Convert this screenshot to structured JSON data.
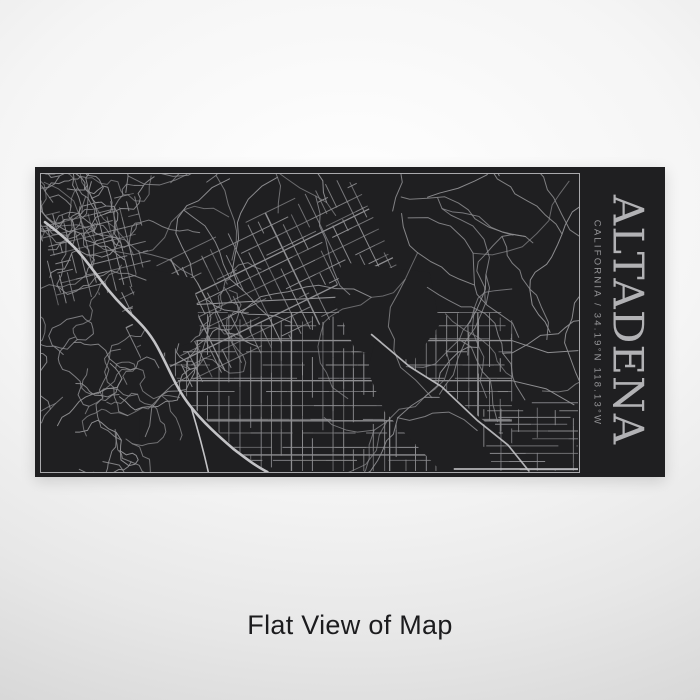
{
  "product": {
    "title": "ALTADENA",
    "subtitle": "CALIFORNIA / 34.19°N 118.13°W",
    "caption": "Flat View of Map",
    "location": "Altadena",
    "state": "California",
    "latitude": "34.19°N",
    "longitude": "118.13°W"
  },
  "map": {
    "style": "engraved dark street map",
    "seed": 9
  },
  "colors": {
    "panel_bg": "#1f1f21",
    "frame_line": "#a9a9ac",
    "map_line": "#8e8e91",
    "map_line_bright": "#c3c3c6",
    "title_text": "#b2b2b5",
    "subtitle_text": "#959598",
    "caption_text": "#1c1c1e",
    "page_bg_center": "#ffffff",
    "page_bg_edge": "#d3d3d3"
  }
}
